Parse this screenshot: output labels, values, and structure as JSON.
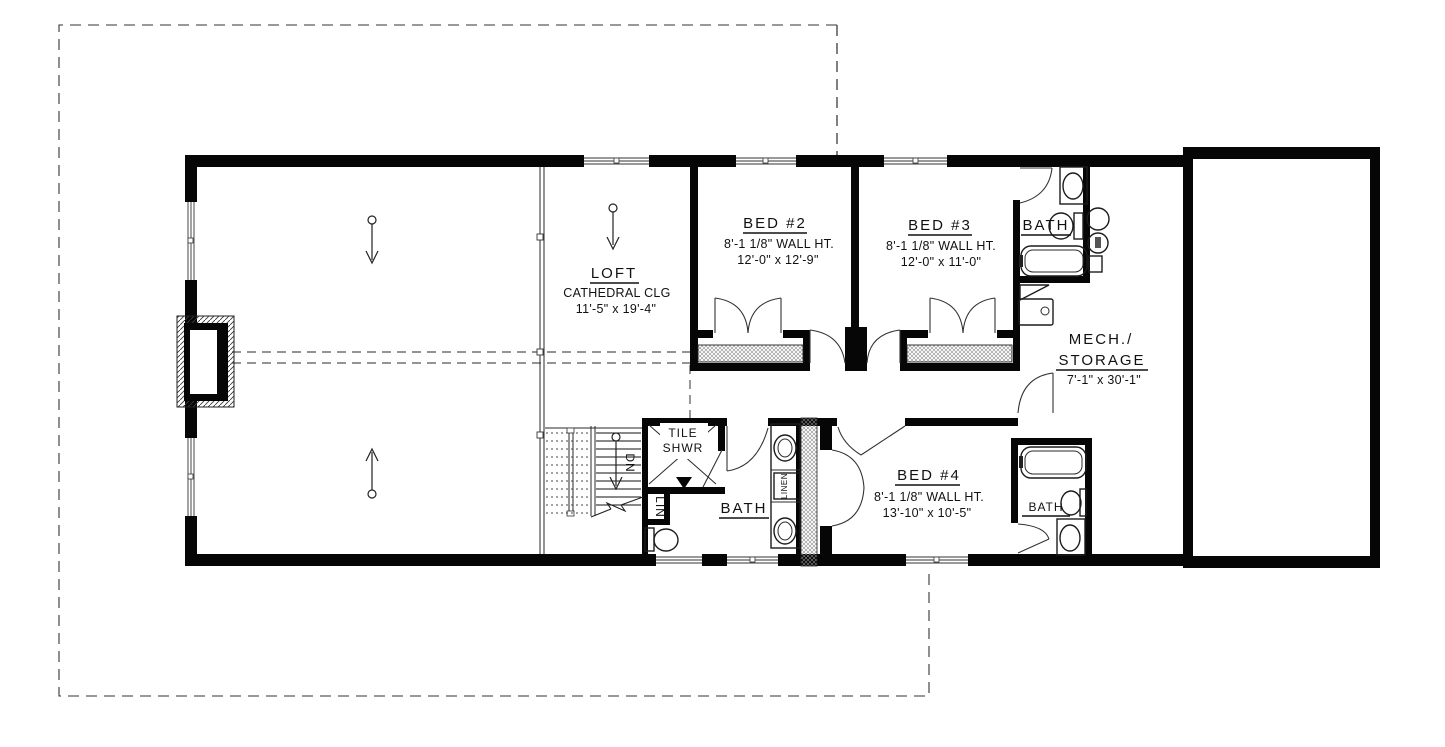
{
  "plan": {
    "loft": {
      "name": "LOFT",
      "ceiling": "CATHEDRAL CLG",
      "dims": "11'-5\" x 19'-4\""
    },
    "bed2": {
      "name": "BED #2",
      "wall": "8'-1 1/8\" WALL HT.",
      "dims": "12'-0\" x 12'-9\""
    },
    "bed3": {
      "name": "BED #3",
      "wall": "8'-1 1/8\" WALL HT.",
      "dims": "12'-0\" x 11'-0\""
    },
    "bed4": {
      "name": "BED #4",
      "wall": "8'-1 1/8\" WALL HT.",
      "dims": "13'-10\" x 10'-5\""
    },
    "bath_top": {
      "name": "BATH"
    },
    "bath_mid": {
      "name": "BATH"
    },
    "bath_br": {
      "name": "BATH"
    },
    "mech": {
      "line1": "MECH./",
      "line2": "STORAGE",
      "dims": "7'-1\" x 30'-1\""
    },
    "shower": {
      "line1": "TILE",
      "line2": "SHWR"
    },
    "stairs": {
      "label": "DN"
    },
    "lin": {
      "label": "LIN"
    },
    "linen": {
      "label": "LINEN"
    }
  }
}
